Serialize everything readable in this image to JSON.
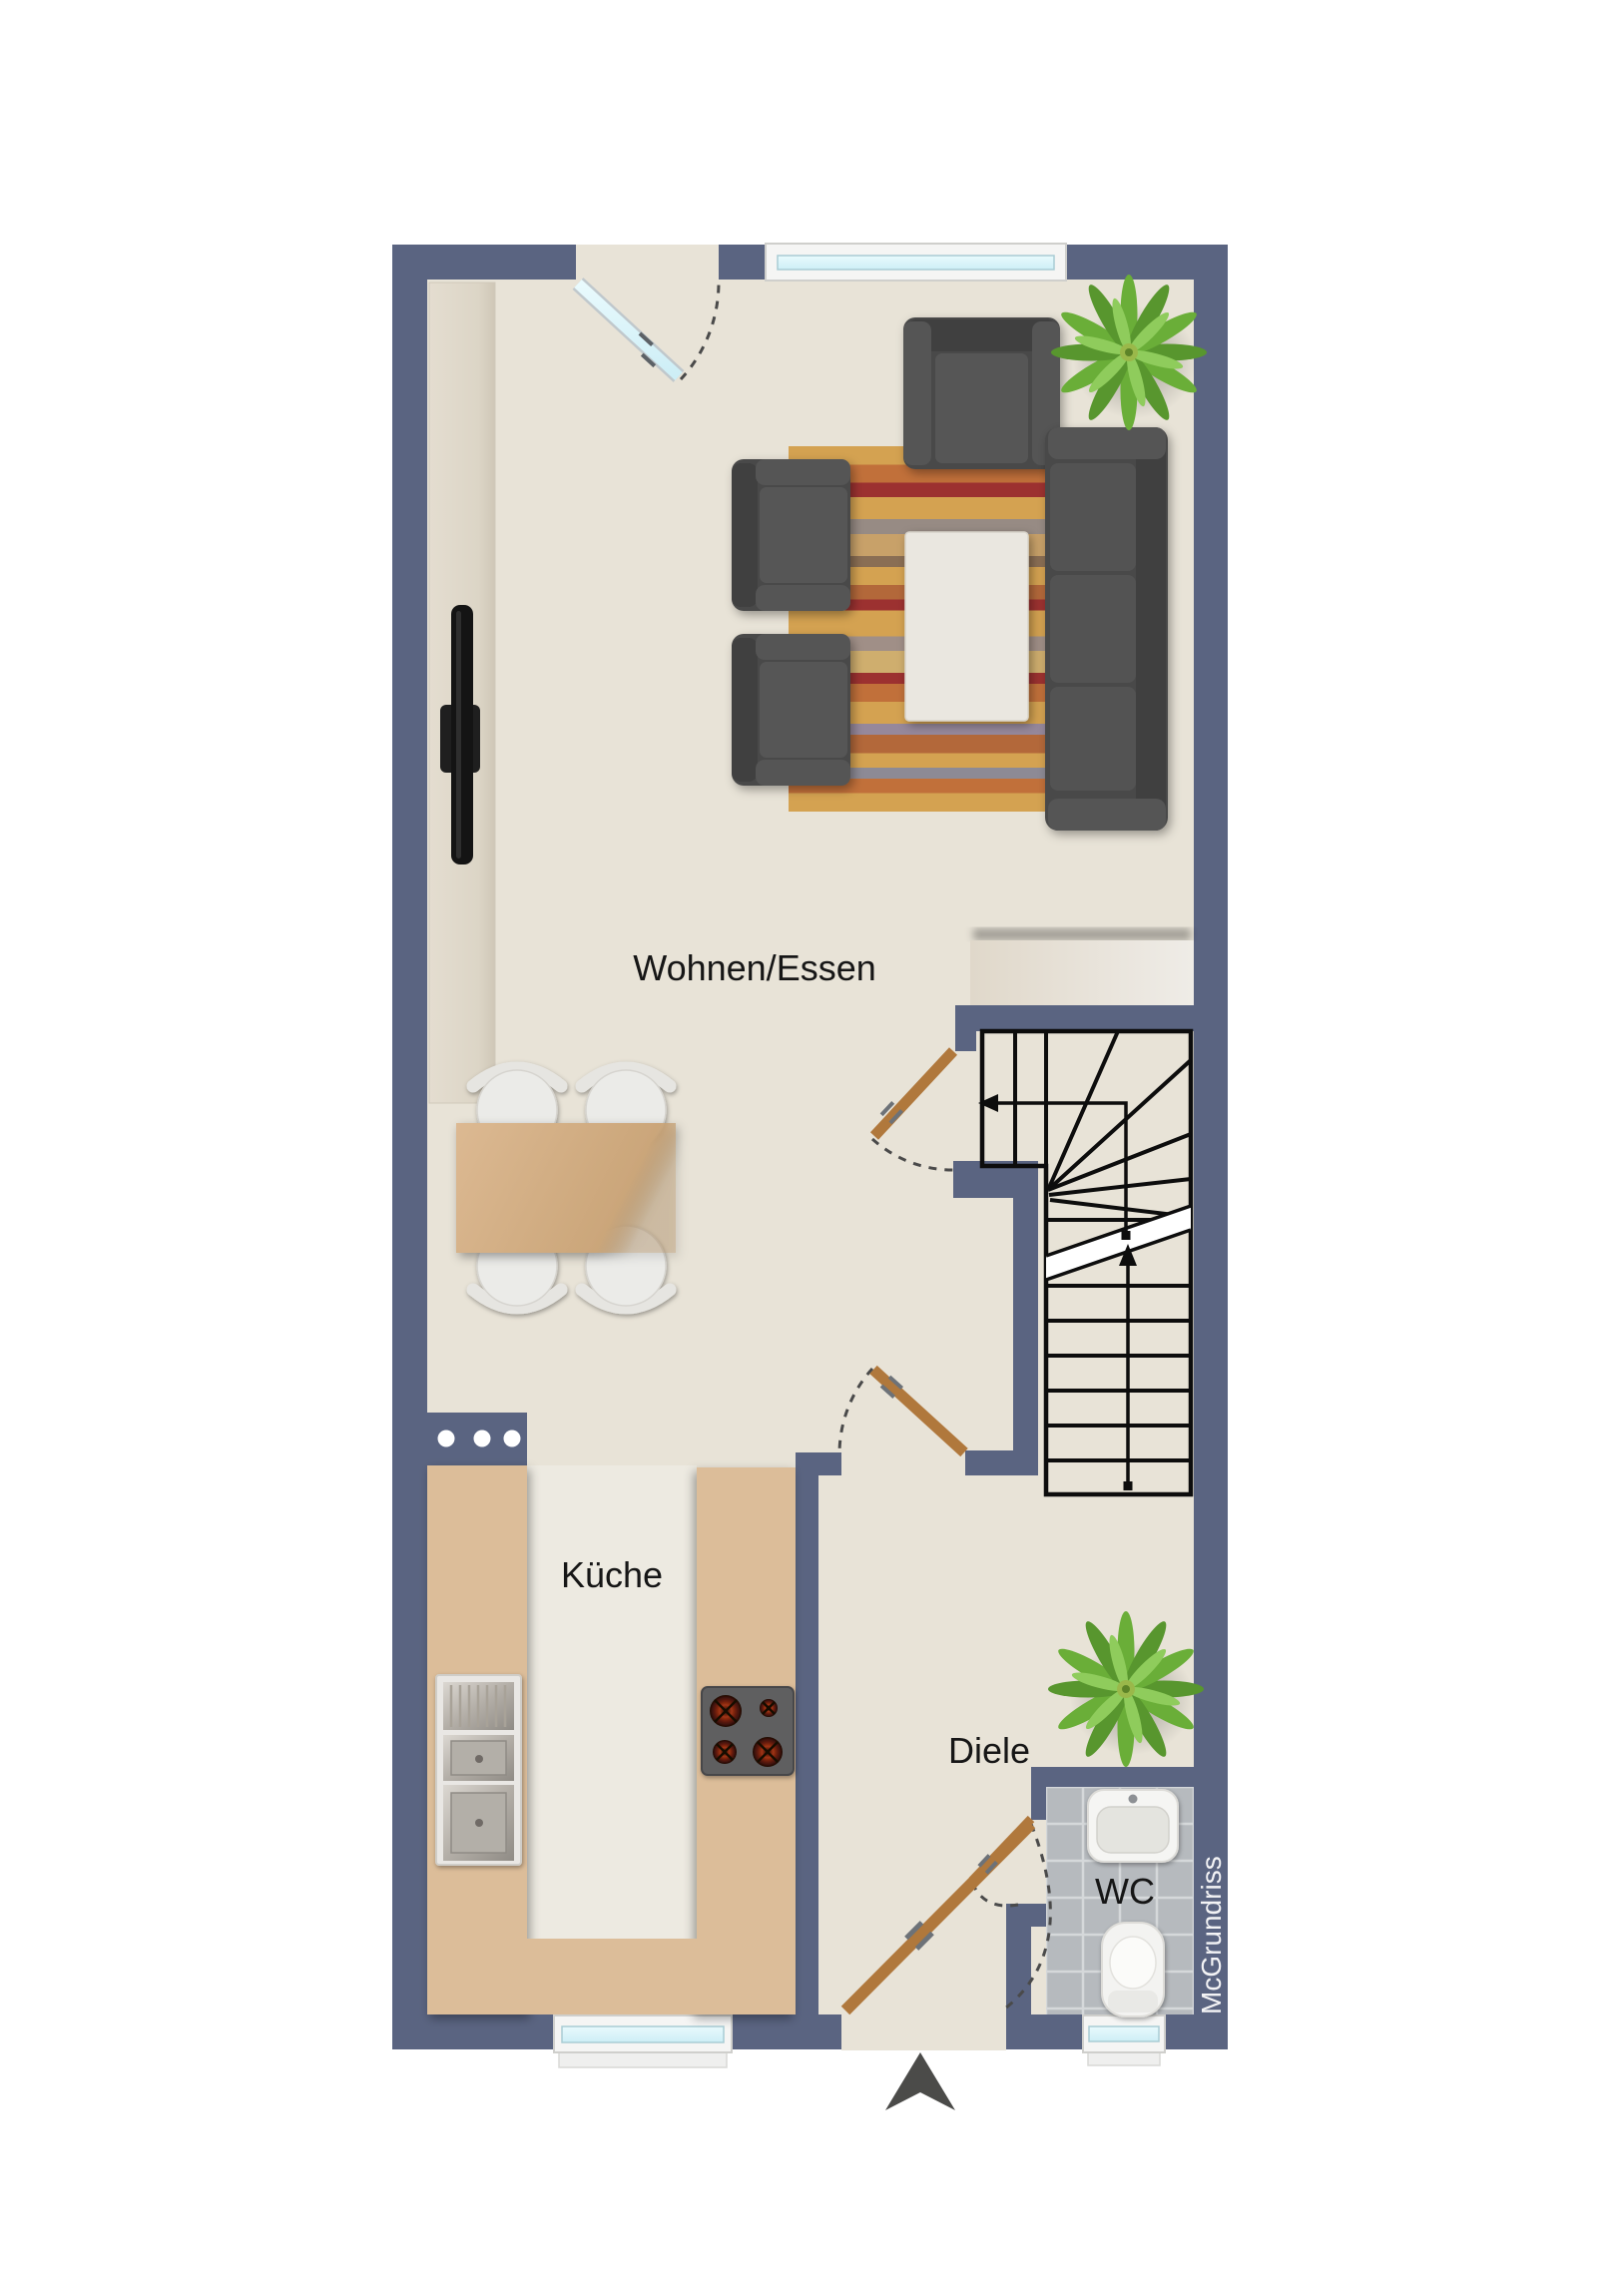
{
  "labels": {
    "living_dining": "Wohnen/Essen",
    "kitchen": "Küche",
    "hallway": "Diele",
    "wc": "WC",
    "watermark": "McGrundriss"
  },
  "colors": {
    "wall": "#5a6481",
    "floor": "#e8e3d7",
    "kitchen_floor": "#edeae1",
    "counter": "#dcbd99",
    "wood_door": "#b0783c",
    "glass": "#ddf4fa",
    "window_frame": "#f5f5f4",
    "sofa": "#4a4a4a",
    "rug_base": "#d4a251",
    "table_wood": "#d2ad83",
    "wc_tile": "#b6babe",
    "plant": "#6aae38",
    "stair_line": "#0d0d0d",
    "label_text": "#161616",
    "watermark_text": "#f3f3f5",
    "north_arrow": "#4b4b49"
  }
}
